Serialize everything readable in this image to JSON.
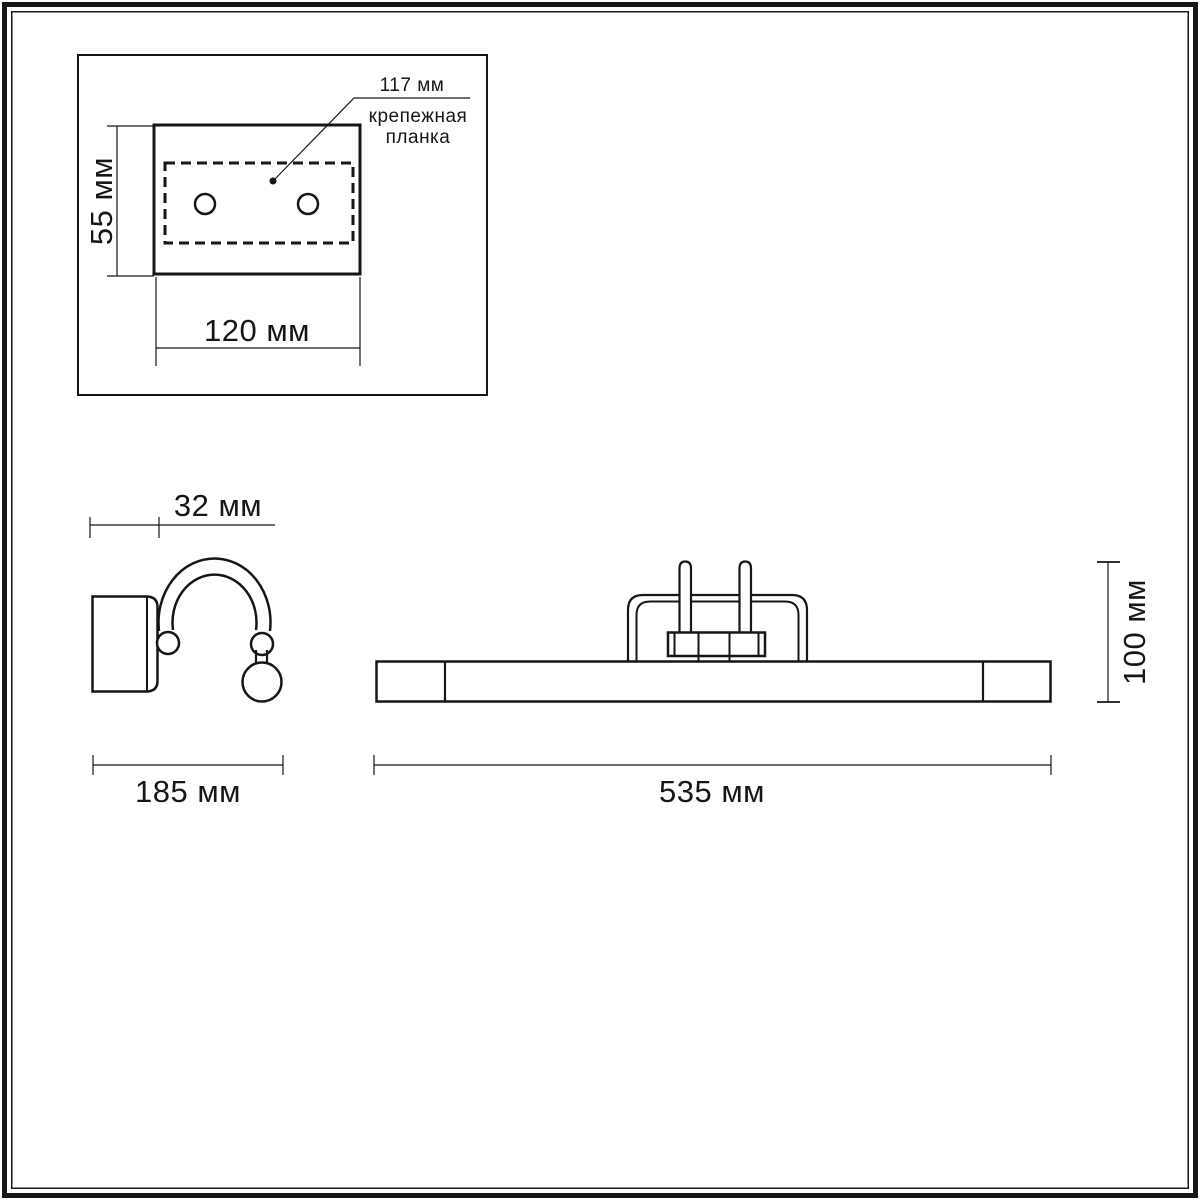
{
  "colors": {
    "line": "#161616",
    "background": "#ffffff"
  },
  "views": {
    "mounting_plate": {
      "callout_value": "117 мм",
      "callout_label_line1": "крепежная",
      "callout_label_line2": "планка",
      "height_label": "55 мм",
      "width_label": "120 мм"
    },
    "side": {
      "depth_label": "32 мм",
      "width_label": "185 мм"
    },
    "front": {
      "height_label": "100 мм",
      "width_label": "535 мм"
    }
  }
}
